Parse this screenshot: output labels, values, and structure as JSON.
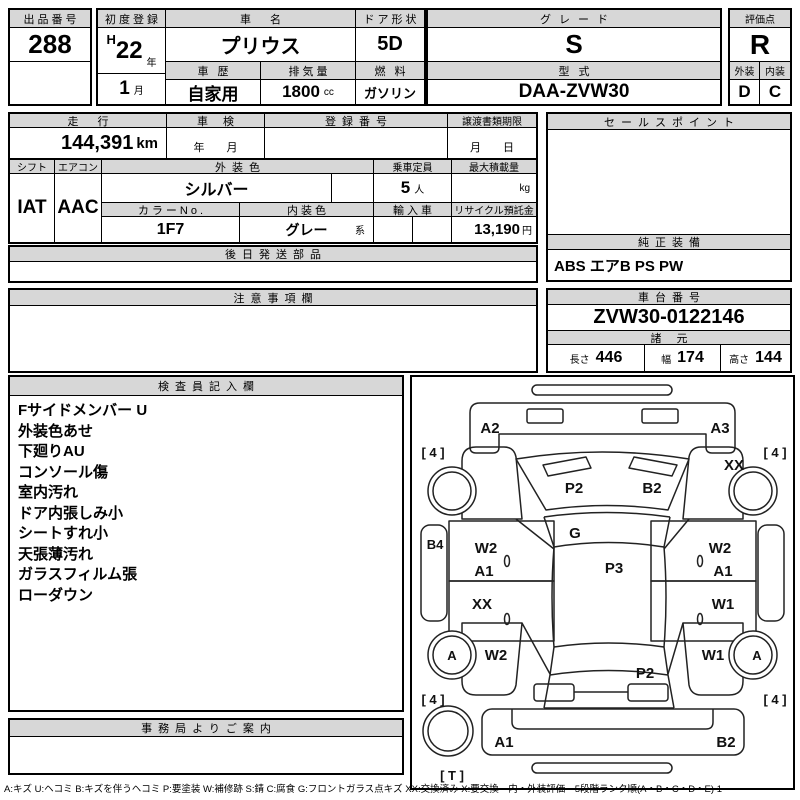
{
  "sheet": {
    "lot": {
      "label": "出品番号",
      "value": "288"
    },
    "first_reg": {
      "label": "初度登録",
      "era": "H",
      "year": "22",
      "year_unit": "年",
      "month": "1",
      "month_unit": "月"
    },
    "name": {
      "label": "車 名",
      "value": "プリウス"
    },
    "door": {
      "label": "ドア形状",
      "value": "5D"
    },
    "grade": {
      "label": "グレード",
      "value": "S"
    },
    "score": {
      "label": "評価点",
      "value": "R"
    },
    "history": {
      "label": "車 歴",
      "value": "自家用"
    },
    "cc": {
      "label": "排気量",
      "value": "1800",
      "unit": "cc"
    },
    "fuel": {
      "label": "燃 料",
      "value": "ガソリン"
    },
    "model": {
      "label": "型 式",
      "value": "DAA-ZVW30"
    },
    "exterior": {
      "label": "外装",
      "value": "D"
    },
    "interior": {
      "label": "内装",
      "value": "C"
    },
    "mileage": {
      "label": "走 行",
      "value": "144,391",
      "unit": "km"
    },
    "shaken": {
      "label": "車 検",
      "value": "年　　月"
    },
    "regno": {
      "label": "登録番号",
      "value": ""
    },
    "deadline": {
      "label": "譲渡書類期限",
      "value": "月　　日"
    },
    "shift": {
      "label": "シフト",
      "value": "IAT"
    },
    "ac": {
      "label": "エアコン",
      "value": "AAC"
    },
    "ext_color": {
      "label": "外装色",
      "value": "シルバー"
    },
    "capacity": {
      "label": "乗車定員",
      "value": "5",
      "unit": "人"
    },
    "payload": {
      "label": "最大積載量",
      "value": "",
      "unit": "kg"
    },
    "color_no": {
      "label": "カラーNo.",
      "value": "1F7"
    },
    "int_color": {
      "label": "内装色",
      "value": "グレー",
      "unit": "系"
    },
    "imported": {
      "label": "輸入車",
      "value": ""
    },
    "recycle": {
      "label": "リサイクル預託金",
      "value": "13,190",
      "unit": "円"
    },
    "late_parts": {
      "label": "後日発送部品",
      "value": ""
    },
    "sales_point": {
      "label": "セールスポイント",
      "value": ""
    },
    "equipment": {
      "label": "純正装備",
      "value": "ABS エアB PS PW"
    },
    "caution": {
      "label": "注意事項欄",
      "value": ""
    },
    "chassis": {
      "label": "車台番号",
      "value": "ZVW30-0122146"
    },
    "spec": {
      "label": "諸 元",
      "len_label": "長さ",
      "len": "446",
      "wid_label": "幅",
      "wid": "174",
      "hgt_label": "高さ",
      "hgt": "144"
    },
    "inspector": {
      "label": "検査員記入欄",
      "items": [
        "Fサイドメンバー U",
        "外装色あせ",
        "下廻りAU",
        "コンソール傷",
        "室内汚れ",
        "ドア内張しみ小",
        "シートすれ小",
        "天張薄汚れ",
        "ガラスフィルム張",
        "ローダウン"
      ]
    },
    "office": {
      "label": "事務局よりご案内",
      "value": ""
    }
  },
  "diagram": {
    "labels": [
      {
        "code": "A2",
        "x": 78,
        "y": 56
      },
      {
        "code": "A3",
        "x": 308,
        "y": 56
      },
      {
        "code": "[ 4 ]",
        "x": 21,
        "y": 80,
        "small": true
      },
      {
        "code": "[ 4 ]",
        "x": 363,
        "y": 80,
        "small": true
      },
      {
        "code": "XX",
        "x": 322,
        "y": 93
      },
      {
        "code": "P2",
        "x": 162,
        "y": 116
      },
      {
        "code": "B2",
        "x": 240,
        "y": 116
      },
      {
        "code": "B4",
        "x": 23,
        "y": 172,
        "small": true
      },
      {
        "code": "G",
        "x": 163,
        "y": 161
      },
      {
        "code": "W2",
        "x": 74,
        "y": 176
      },
      {
        "code": "A1",
        "x": 72,
        "y": 199
      },
      {
        "code": "W2",
        "x": 308,
        "y": 176
      },
      {
        "code": "A1",
        "x": 311,
        "y": 199
      },
      {
        "code": "P3",
        "x": 202,
        "y": 196
      },
      {
        "code": "XX",
        "x": 70,
        "y": 232
      },
      {
        "code": "W1",
        "x": 311,
        "y": 232
      },
      {
        "code": "A",
        "x": 40,
        "y": 283,
        "small": true
      },
      {
        "code": "W2",
        "x": 84,
        "y": 283
      },
      {
        "code": "W1",
        "x": 301,
        "y": 283
      },
      {
        "code": "A",
        "x": 345,
        "y": 283,
        "small": true
      },
      {
        "code": "P2",
        "x": 233,
        "y": 301
      },
      {
        "code": "[ 4 ]",
        "x": 21,
        "y": 327,
        "small": true
      },
      {
        "code": "[ 4 ]",
        "x": 363,
        "y": 327,
        "small": true
      },
      {
        "code": "A1",
        "x": 92,
        "y": 370
      },
      {
        "code": "B2",
        "x": 314,
        "y": 370
      },
      {
        "code": "[ T ]",
        "x": 40,
        "y": 403,
        "small": true
      }
    ]
  },
  "legend": "A:キズ U:ヘコミ B:キズを伴うヘコミ P:要塗装 W:補修跡 S:錆 C:腐食 G:フロントガラス点キズ XX:交換済み X:要交換　内・外装評価　5段階ランク順(A・B・C・D・E) 1"
}
